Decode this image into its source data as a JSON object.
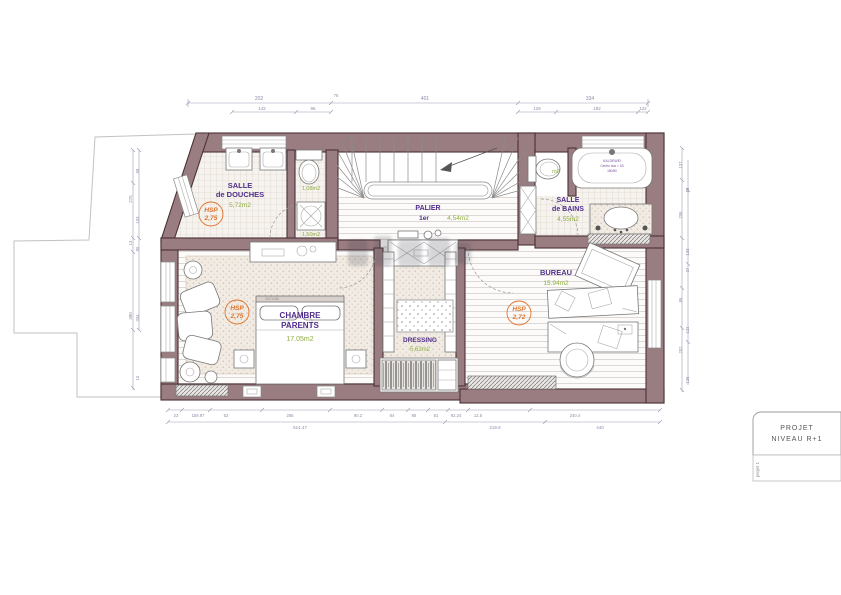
{
  "colors": {
    "wall": "#9a7d80",
    "label_purple": "#4f2d8c",
    "area_green": "#8fae3f",
    "hsp_orange": "#e0742c"
  },
  "rooms": {
    "douches": {
      "name1": "SALLE",
      "name2": "de DOUCHES",
      "area": "5,72m2",
      "hsp1": "HSP",
      "hsp2": "2,75"
    },
    "wc": {
      "area": "1,08m2"
    },
    "buanderie": {
      "area": "1,50m2"
    },
    "palier": {
      "name": "PALIER",
      "level": "1er",
      "area": "4,54m2"
    },
    "wc2": {
      "area": "m2"
    },
    "bains": {
      "name1": "SALLE",
      "name2": "de BAINS",
      "area": "4,55m2",
      "tub_brand": "KALDEWEI",
      "tub_model": "Centro duo = 1B",
      "tub_size": "180/80"
    },
    "chambre": {
      "name1": "CHAMBRE",
      "name2": "PARENTS",
      "area": "17.05m2",
      "hsp1": "HSP",
      "hsp2": "2,75",
      "code": "XXCY060"
    },
    "dressing": {
      "name": "DRESSING",
      "area": "5,62m2"
    },
    "bureau": {
      "name": "BUREAU",
      "area": "15.94m2",
      "hsp1": "HSP",
      "hsp2": "2,72"
    }
  },
  "dims": {
    "top1": [
      "202",
      "75",
      "401",
      "334"
    ],
    "top2": [
      "142",
      "96",
      "128",
      "182",
      "122"
    ],
    "bottom1": [
      "23",
      "159.97",
      "52",
      "265",
      "90.2",
      "84",
      "85",
      "81",
      "92.24",
      "12.5",
      "240.4"
    ],
    "bottom2": [
      "514.47",
      "219.9",
      "440"
    ],
    "left": [
      "58",
      "275",
      "103",
      "13",
      "85",
      "380",
      "334",
      "15"
    ],
    "right": [
      "137",
      "88",
      "206",
      "133",
      "37",
      "86",
      "122",
      "202",
      "126"
    ]
  },
  "title_block": {
    "line1": "PROJET",
    "line2": "NIVEAU R+1",
    "side": "projet 1"
  }
}
